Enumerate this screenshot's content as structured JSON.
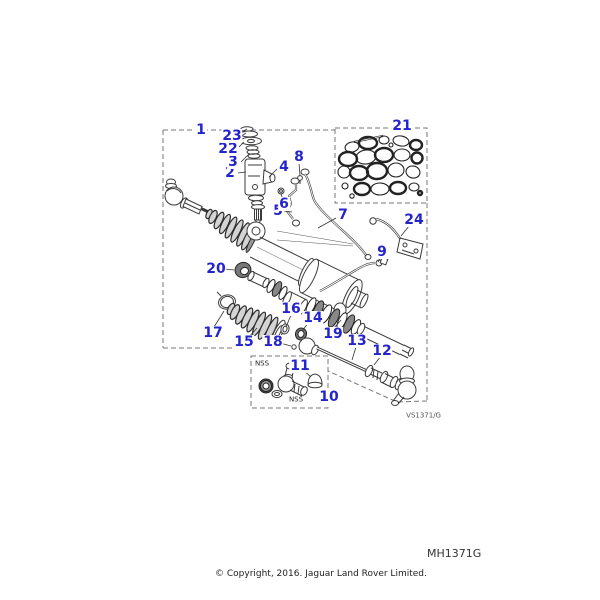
{
  "page": {
    "background": "#ffffff",
    "drawing_code": "VS1371/G",
    "figure_code": "MH1371G",
    "copyright": "© Copyright, 2016. Jaguar Land Rover Limited."
  },
  "diagram": {
    "description": "Exploded parts diagram of a power steering rack and pinion assembly",
    "accent_color": "#2424cd",
    "nss_label": "NSS",
    "part_labels": [
      "1",
      "2",
      "3",
      "4",
      "5",
      "6",
      "7",
      "8",
      "9",
      "10",
      "11",
      "12",
      "13",
      "14",
      "15",
      "16",
      "17",
      "18",
      "19",
      "20",
      "21",
      "22",
      "23",
      "24"
    ]
  }
}
